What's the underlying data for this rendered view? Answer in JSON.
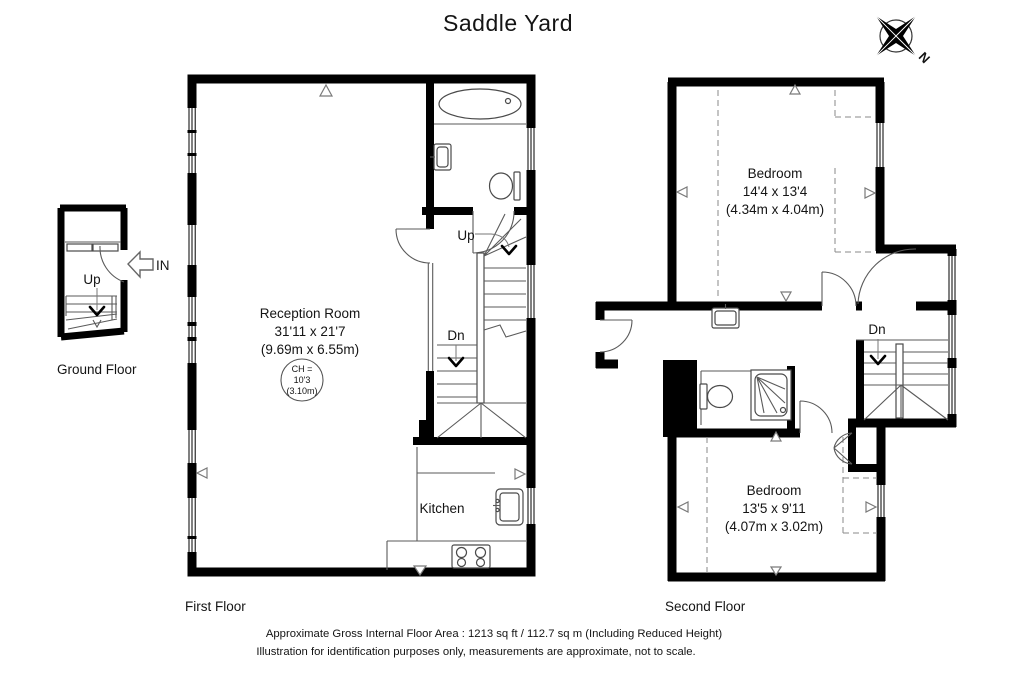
{
  "title": "Saddle Yard",
  "compass": {
    "north": "N"
  },
  "ground_floor": {
    "label": "Ground Floor",
    "stairs_up": "Up",
    "entrance": "IN"
  },
  "first_floor": {
    "label": "First Floor",
    "reception_room": {
      "name": "Reception Room",
      "size_imperial": "31'11 x 21'7",
      "size_metric": "(9.69m x 6.55m)",
      "ceiling_height": {
        "line1": "CH =",
        "line2": "10'3",
        "line3": "(3.10m)"
      }
    },
    "kitchen": {
      "name": "Kitchen"
    },
    "stairs_up": "Up",
    "stairs_down": "Dn"
  },
  "second_floor": {
    "label": "Second Floor",
    "bedroom_front": {
      "name": "Bedroom",
      "size_imperial": "14'4 x 13'4",
      "size_metric": "(4.34m x 4.04m)"
    },
    "bedroom_back": {
      "name": "Bedroom",
      "size_imperial": "13'5 x 9'11",
      "size_metric": "(4.07m x 3.02m)"
    },
    "stairs_down": "Dn"
  },
  "footer": {
    "line1": "Approximate Gross Internal Floor Area : 1213 sq ft / 112.7 sq m (Including Reduced Height)",
    "line2": "Illustration for identification purposes only, measurements are approximate, not to scale."
  },
  "colors": {
    "walls": "#000000",
    "fixtures": "#555555",
    "background": "#ffffff"
  }
}
